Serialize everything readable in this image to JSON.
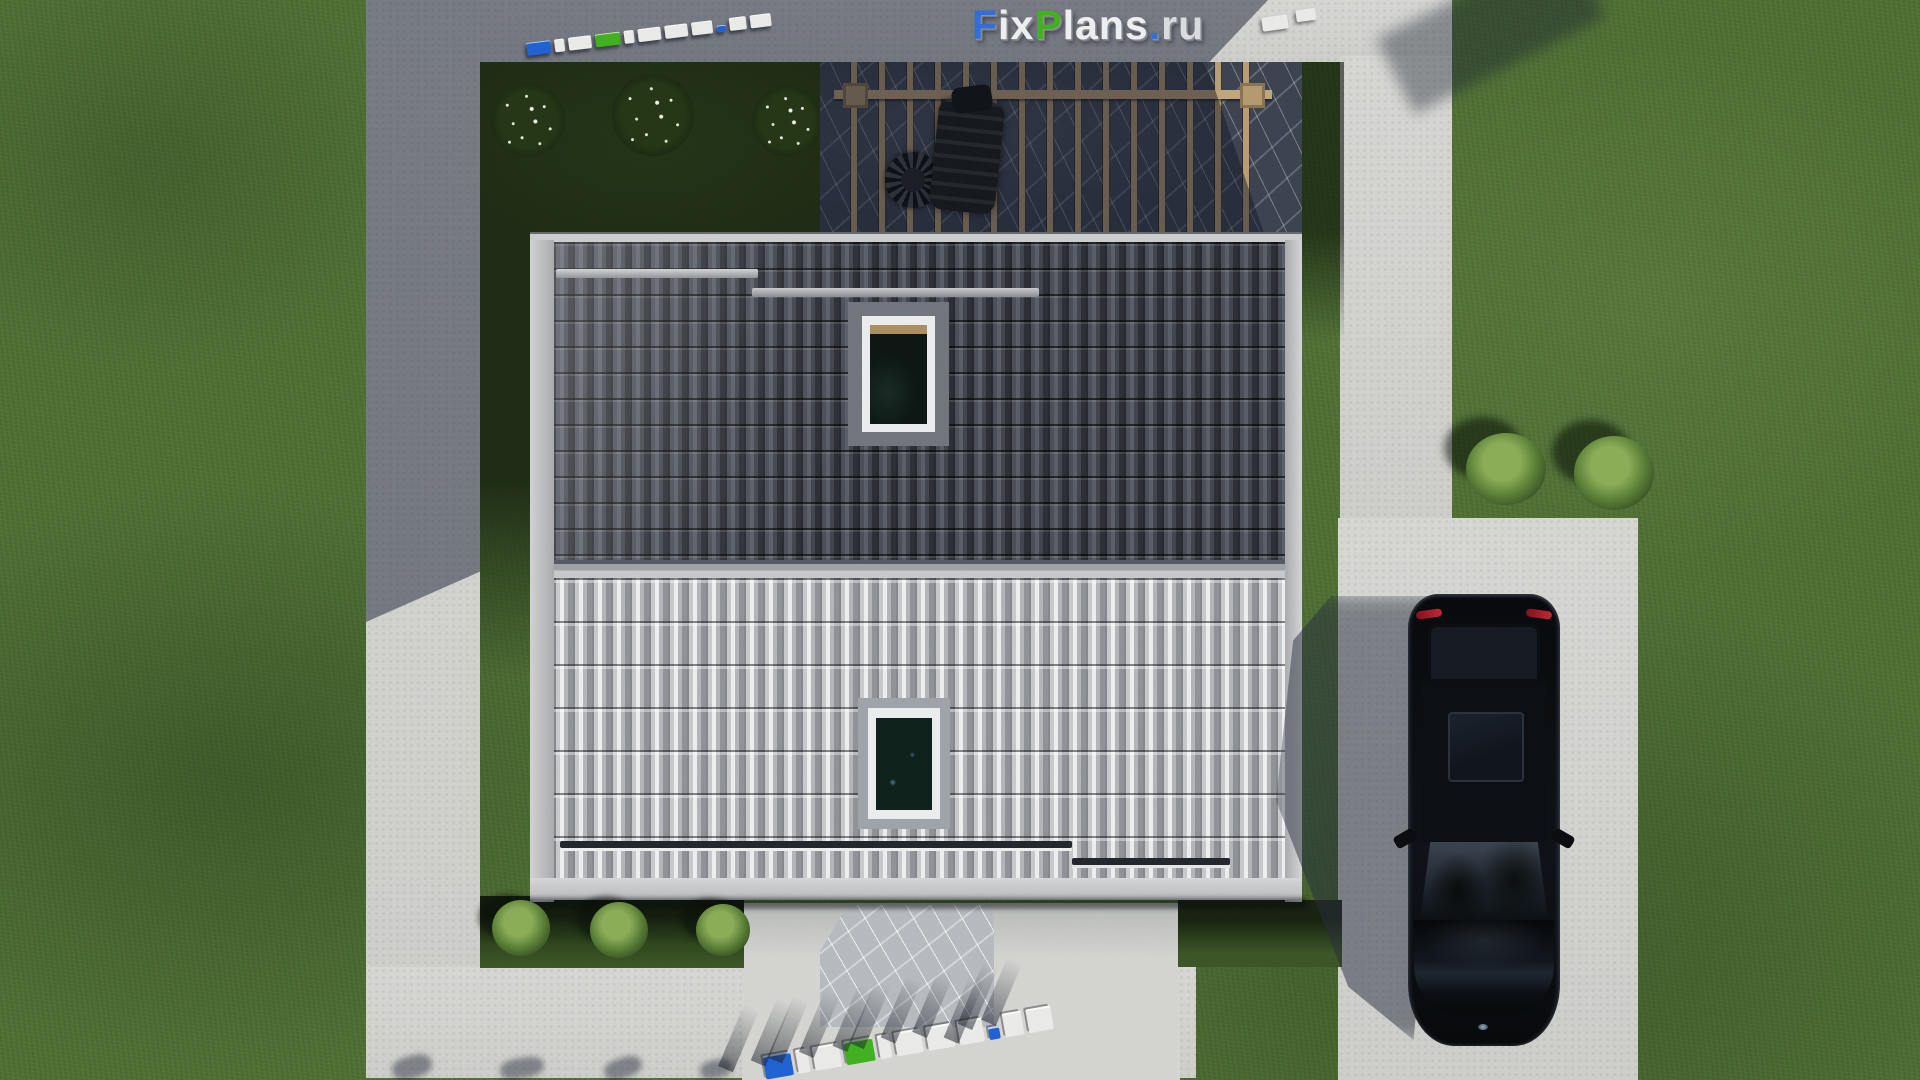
{
  "logo": {
    "text": "FixPlans.ru",
    "letters": [
      {
        "ch": "F",
        "color": "#2e6bd6"
      },
      {
        "ch": "i",
        "color": "#eceef0"
      },
      {
        "ch": "x",
        "color": "#eceef0"
      },
      {
        "ch": "P",
        "color": "#3fae1f"
      },
      {
        "ch": "l",
        "color": "#eceef0"
      },
      {
        "ch": "a",
        "color": "#eceef0"
      },
      {
        "ch": "n",
        "color": "#eceef0"
      },
      {
        "ch": "s",
        "color": "#eceef0"
      },
      {
        "ch": ".",
        "color": "#2e6bd6"
      },
      {
        "ch": "r",
        "color": "#d8dadd"
      },
      {
        "ch": "u",
        "color": "#d8dadd"
      }
    ]
  },
  "watermark3d": {
    "text": "FixPlans.ru",
    "colors": {
      "white": "#e9eae7",
      "blue": "#1f5fd0",
      "green": "#3fae1f"
    },
    "letter_blocks": [
      {
        "ch": "F",
        "w": 26,
        "c": "blue"
      },
      {
        "ch": "i",
        "w": 11,
        "c": "white"
      },
      {
        "ch": "x",
        "w": 25,
        "c": "white"
      },
      {
        "ch": "P",
        "w": 27,
        "c": "green"
      },
      {
        "ch": "l",
        "w": 11,
        "c": "white"
      },
      {
        "ch": "a",
        "w": 25,
        "c": "white"
      },
      {
        "ch": "n",
        "w": 25,
        "c": "white"
      },
      {
        "ch": "s",
        "w": 23,
        "c": "white"
      },
      {
        "ch": ".",
        "w": 10,
        "c": "blue"
      },
      {
        "ch": "r",
        "w": 18,
        "c": "white"
      },
      {
        "ch": "u",
        "w": 23,
        "c": "white"
      }
    ]
  },
  "scene": {
    "title": "Top-down 3D render of a single-family house plot",
    "house": {
      "roof": "gable roof: shaded dark north slope, sunlit light south slope",
      "skylights": 2,
      "snow_guard_bars": 4
    },
    "pergola": {
      "beams": 15,
      "floor": "dark marble patio",
      "furniture": [
        "round wicker chair",
        "lounge chair",
        "cushion"
      ]
    },
    "vehicle": {
      "type": "car",
      "color": "black",
      "location": "driveway",
      "heading": "south"
    },
    "landscape": {
      "flowering_shrubs": 3,
      "right_lawn_bushes": 2,
      "foundation_bushes": 3,
      "lawn": "green grass",
      "walkways": "light concrete, L-shaped around plot"
    }
  },
  "palette": {
    "grass": "#4d6c33",
    "grass_shadow": "#1e2b15",
    "concrete": "#d2d3cf",
    "concrete_shadow": "#79819a",
    "roof_dark": "#3e424a",
    "roof_light": "#b5b7ba",
    "marble_dark": "#39414d",
    "marble_light": "#b4b8bd",
    "pergola_wood": "#b59a6e",
    "car_black": "#0a0d11",
    "logo_blue": "#2e6bd6",
    "logo_green": "#3fae1f"
  }
}
